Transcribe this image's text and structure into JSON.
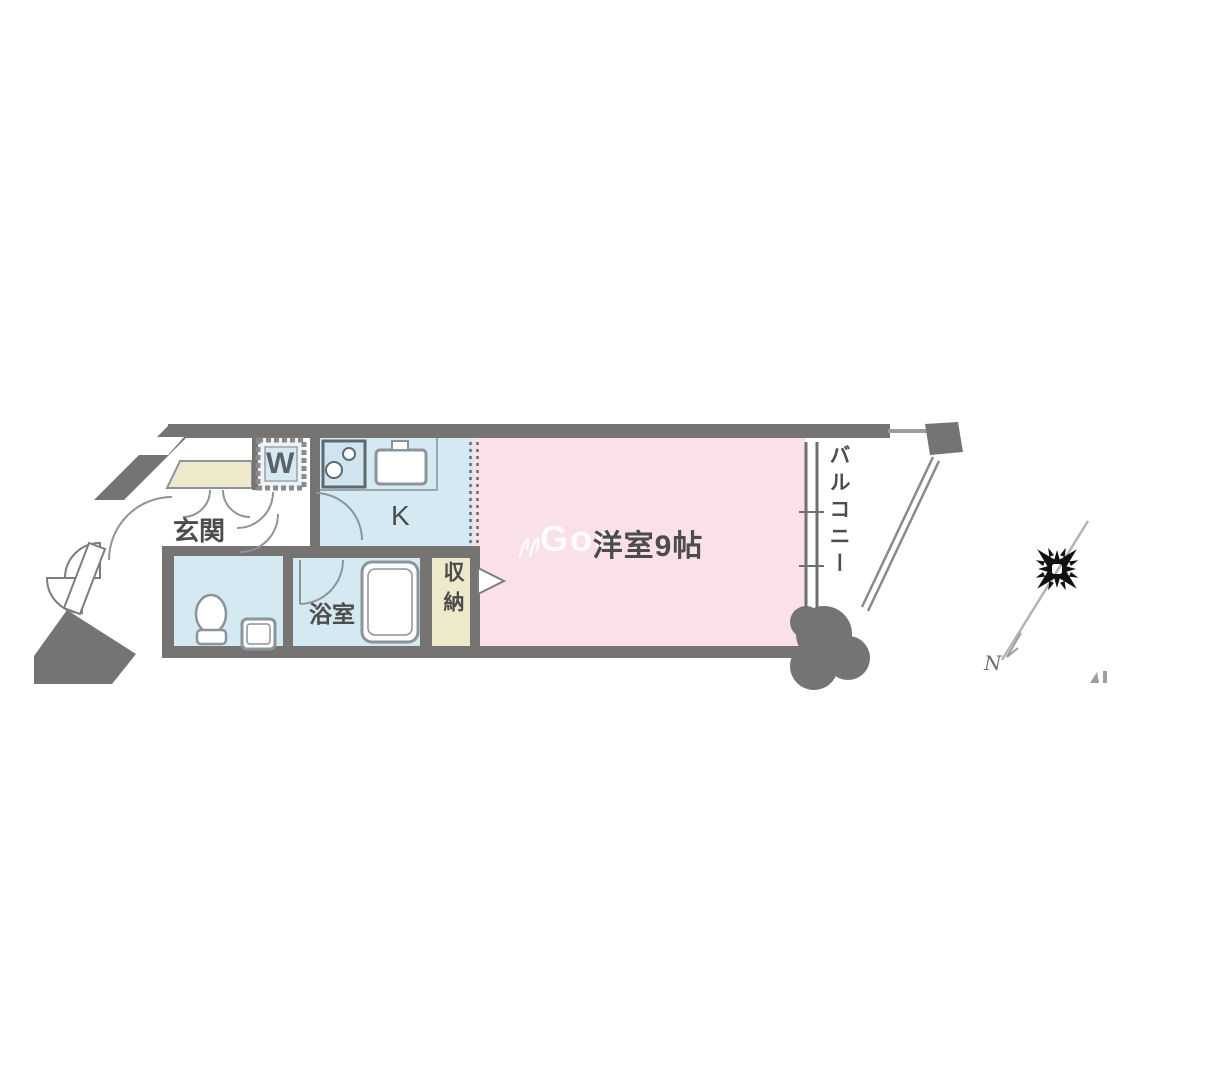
{
  "plan": {
    "labels": {
      "genkan": "玄関",
      "washer": "W",
      "kitchen": "K",
      "main_room": "洋室9帖",
      "bathroom": "浴室",
      "storage": "収納",
      "balcony": "バルコニー"
    },
    "compass": {
      "north_label": "N"
    },
    "watermark": {
      "text": "Goo"
    },
    "colors": {
      "wall": "#757472",
      "wet_area_floor": "#d5e9f3",
      "main_room_floor": "#f9e1e7",
      "storage_floor": "#eee9cb",
      "fixture_line": "#8b949b",
      "label_text": "#4c4c4c"
    }
  }
}
